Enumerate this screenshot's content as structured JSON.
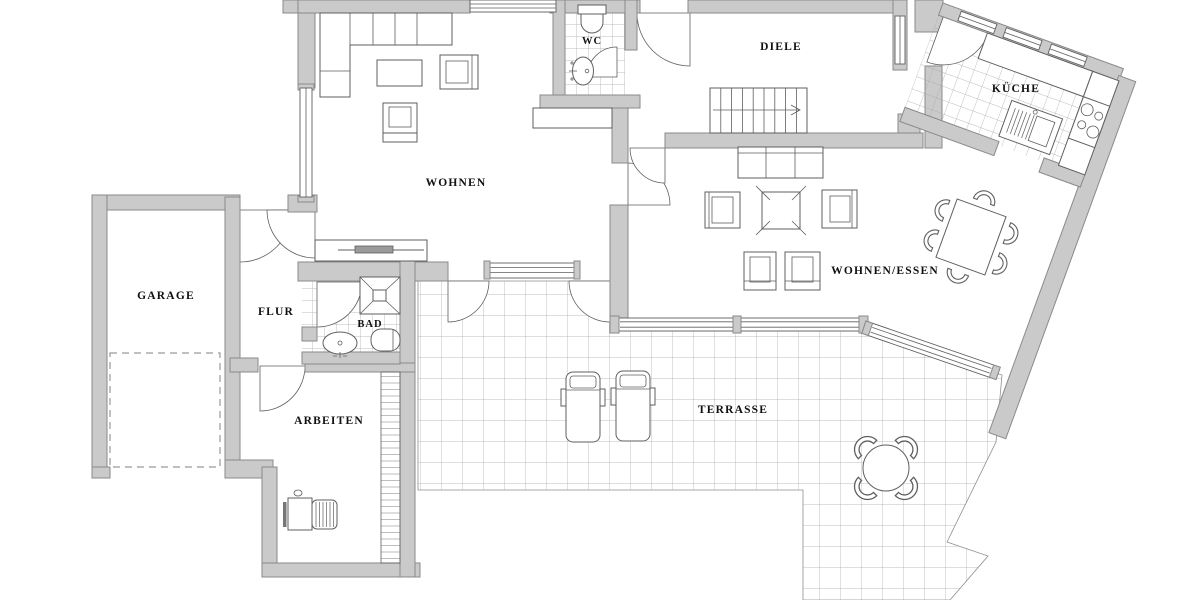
{
  "plan": {
    "rooms": {
      "garage": "GARAGE",
      "flur": "FLUR",
      "bad": "BAD",
      "arbeiten": "ARBEITEN",
      "wohnen": "WOHNEN",
      "wc": "WC",
      "diele": "DIELE",
      "kueche": "KÜCHE",
      "wohnen_essen": "WOHNEN/ESSEN",
      "terrasse": "TERRASSE"
    },
    "colors": {
      "wall_fill": "#cacaca",
      "wall_stroke": "#8a8a8a",
      "line": "#5f5f5f",
      "tile_line": "#a8a8a8",
      "label": "#111111",
      "background": "#ffffff",
      "furniture_fill": "#ffffff",
      "dash": "#9a9a9a"
    }
  }
}
